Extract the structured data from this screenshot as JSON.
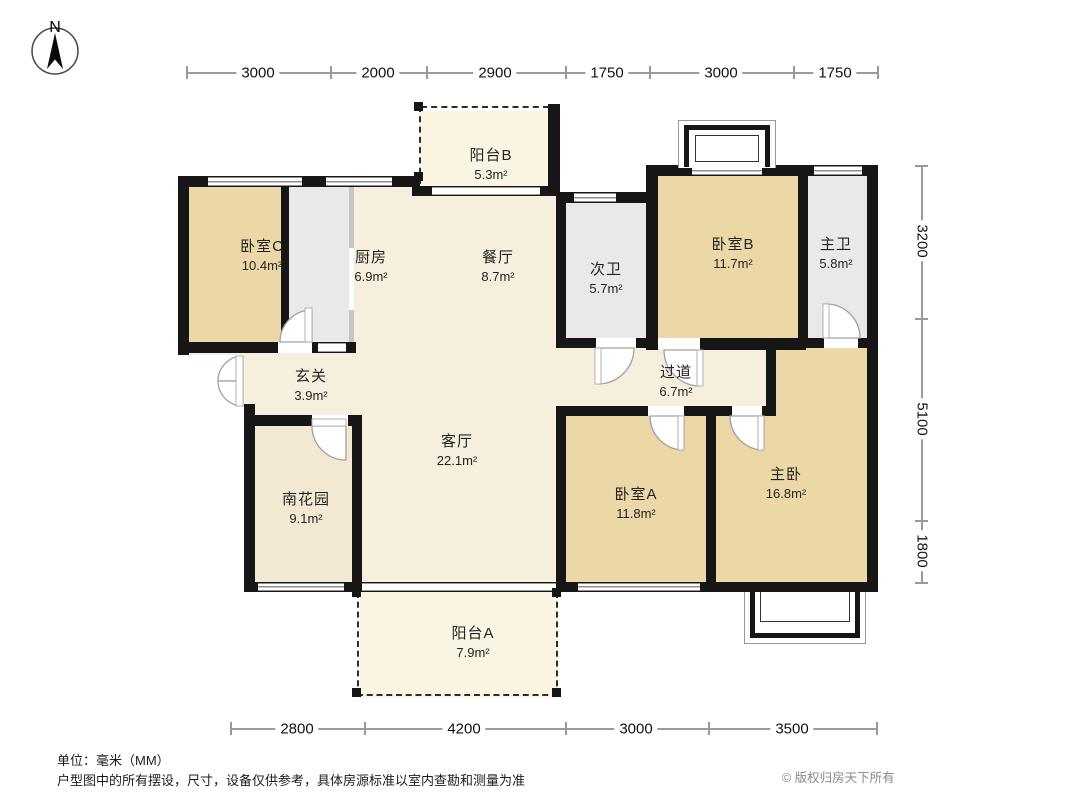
{
  "compass": {
    "label": "N"
  },
  "dimensions": {
    "top": [
      "3000",
      "2000",
      "2900",
      "1750",
      "3000",
      "1750"
    ],
    "bottom": [
      "2800",
      "4200",
      "3000",
      "3500"
    ],
    "right": [
      "3200",
      "5100",
      "1800"
    ]
  },
  "rooms": {
    "bedroomC": {
      "name": "卧室C",
      "area": "10.4m²"
    },
    "kitchen": {
      "name": "厨房",
      "area": "6.9m²"
    },
    "balconyB": {
      "name": "阳台B",
      "area": "5.3m²"
    },
    "dining": {
      "name": "餐厅",
      "area": "8.7m²"
    },
    "bath2": {
      "name": "次卫",
      "area": "5.7m²"
    },
    "bedroomB": {
      "name": "卧室B",
      "area": "11.7m²"
    },
    "bathMaster": {
      "name": "主卫",
      "area": "5.8m²"
    },
    "foyer": {
      "name": "玄关",
      "area": "3.9m²"
    },
    "corridor": {
      "name": "过道",
      "area": "6.7m²"
    },
    "living": {
      "name": "客厅",
      "area": "22.1m²"
    },
    "southGarden": {
      "name": "南花园",
      "area": "9.1m²"
    },
    "bedroomA": {
      "name": "卧室A",
      "area": "11.8m²"
    },
    "masterBedroom": {
      "name": "主卧",
      "area": "16.8m²"
    },
    "balconyA": {
      "name": "阳台A",
      "area": "7.9m²"
    }
  },
  "footer": {
    "unit": "单位：毫米（MM）",
    "disclaimer": "户型图中的所有摆设，尺寸，设备仅供参考，具体房源标准以室内查勘和测量为准",
    "copyright": "© 版权归房天下所有"
  },
  "colors": {
    "wall": "#161616",
    "bedroom": "#ecd7a6",
    "bathroom": "#e9e9e9",
    "hall": "#f7efdd",
    "garden": "#f3e9d2",
    "balcony": "#faf4e3",
    "dimension_line": "#9a9a9a",
    "label_text": "#232323",
    "muted_text": "#8a8a8a"
  }
}
